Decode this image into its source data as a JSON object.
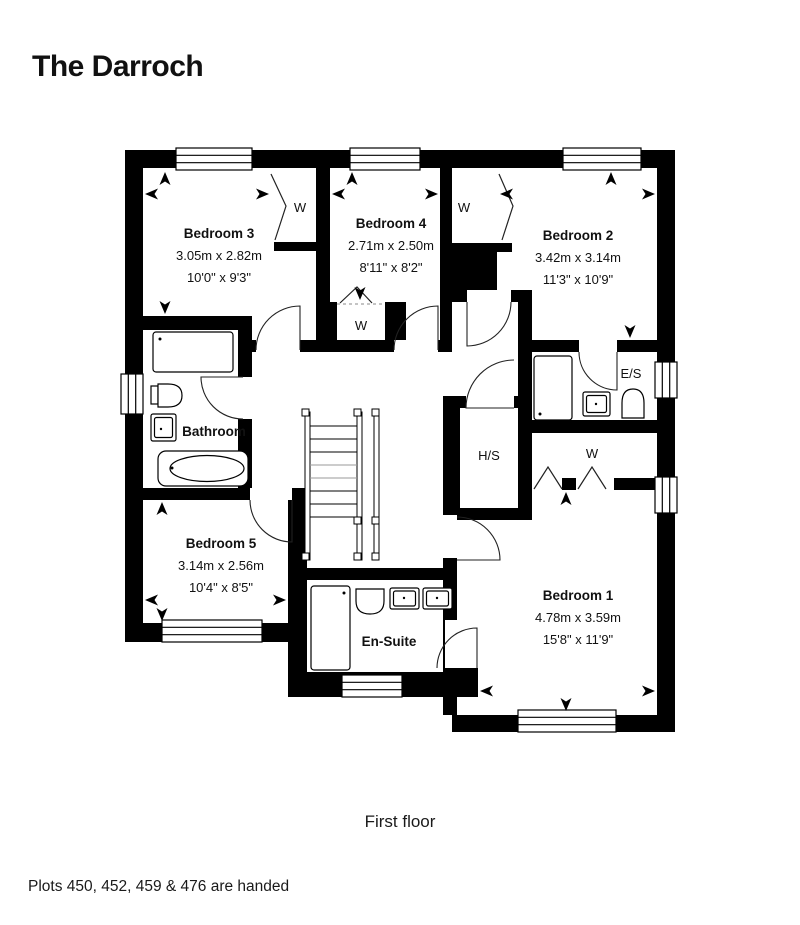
{
  "theme": {
    "accent_color": "#3ab5b0",
    "wall_color": "#000000"
  },
  "header": {
    "title": "The Darroch"
  },
  "plan": {
    "caption": "First floor",
    "rooms": {
      "bedroom3": {
        "name": "Bedroom 3",
        "metric": "3.05m x 2.82m",
        "imperial": "10'0\" x 9'3\""
      },
      "bedroom4": {
        "name": "Bedroom 4",
        "metric": "2.71m x 2.50m",
        "imperial": "8'11\" x 8'2\""
      },
      "bedroom2": {
        "name": "Bedroom 2",
        "metric": "3.42m x 3.14m",
        "imperial": "11'3\" x 10'9\""
      },
      "bedroom5": {
        "name": "Bedroom 5",
        "metric": "3.14m x 2.56m",
        "imperial": "10'4\" x 8'5\""
      },
      "bedroom1": {
        "name": "Bedroom 1",
        "metric": "4.78m x 3.59m",
        "imperial": "15'8\" x 11'9\""
      },
      "bathroom": {
        "name": "Bathroom"
      },
      "ensuite": {
        "name": "En-Suite"
      },
      "es": {
        "name": "E/S"
      },
      "hs": {
        "name": "H/S"
      },
      "wardrobe": {
        "name": "W"
      }
    }
  },
  "footer": {
    "note": "Plots 450, 452, 459 & 476 are handed"
  }
}
